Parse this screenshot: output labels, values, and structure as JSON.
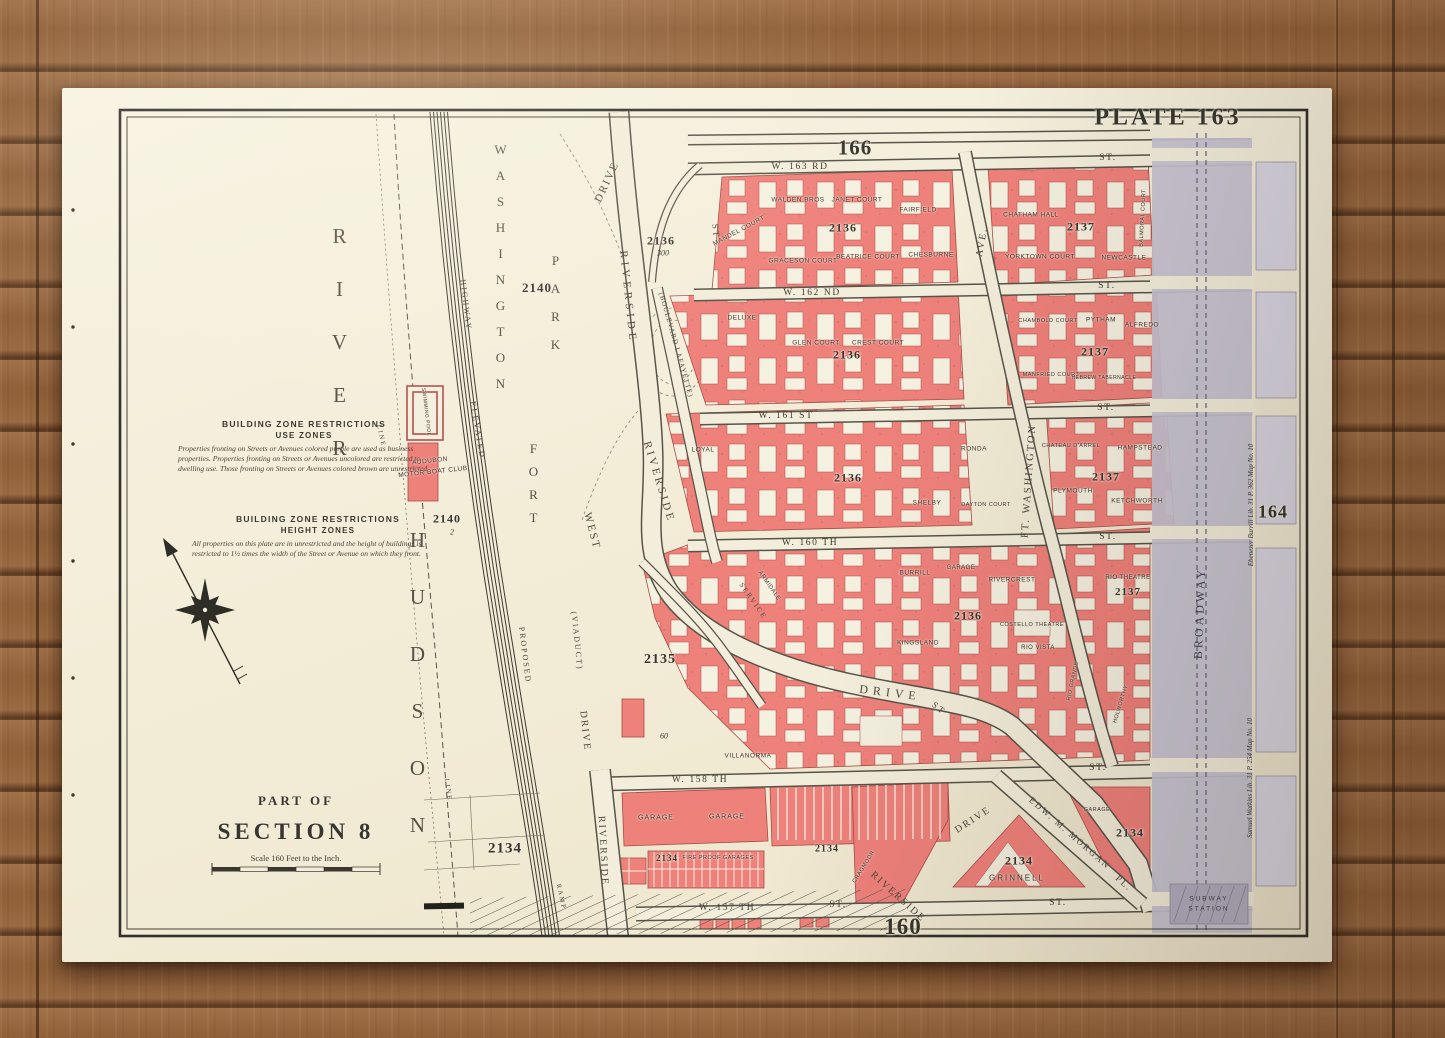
{
  "plate": {
    "label": "PLATE 163",
    "adjoining_top": "166",
    "adjoining_right": "164",
    "adjoining_bottom": "160"
  },
  "title_block": {
    "part_of": "PART OF",
    "section": "SECTION 8",
    "scale": "Scale 160 Feet to the Inch."
  },
  "zone_notes": {
    "use_title": "BUILDING ZONE RESTRICTIONS",
    "use_subtitle": "USE ZONES",
    "use_text": "Properties fronting on Streets or Avenues colored purple are used as business properties. Properties fronting on Streets or Avenues uncolored are restricted to dwelling use. Those fronting on Streets or Avenues colored brown are unrestricted.",
    "height_title": "BUILDING ZONE RESTRICTIONS",
    "height_subtitle": "HEIGHT ZONES",
    "height_text": "All properties on this plate are in unrestricted and the height of buildings is restricted to 1½ times the width of the Street or Avenue on which they front."
  },
  "water": {
    "hudson": "HUDSON",
    "river": "RIVER"
  },
  "park": {
    "fort": "FORT",
    "washington": "WASHINGTON",
    "park": "PARK",
    "pool": "SWIMMING POOL",
    "audubon_line1": "AUDUBON",
    "audubon_line2": "MOTOR BOAT CLUB"
  },
  "numbers": {
    "n2140_park": "2140",
    "n2140_club": "2140",
    "n2_lot": "2",
    "n2136_circle": "2136",
    "n300": "300",
    "n2135": "2135",
    "n2134_shore": "2134",
    "n60": "60"
  },
  "railroad": {
    "elevated": "ELEVATED",
    "highway": "HIGHWAY",
    "proposed": "PROPOSED",
    "ramp": "RAMP",
    "line": "LINE"
  },
  "roads": {
    "drive_top": "DRIVE",
    "riverside_upper": "RIVERSIDE",
    "boulevard_lafayette": "(BOULEVARD LAFAYETTE)",
    "riverside_mid": "RIVERSIDE",
    "west": "WEST",
    "viaduct": "(VIADUCT)",
    "drive_viaduct": "DRIVE",
    "riverside_sw": "RIVERSIDE",
    "service": "SERVICE",
    "drive_curve": "DRIVE",
    "st_curve": "ST",
    "st_upper": "ST",
    "riverside_diag": "RIVERSIDE",
    "drive_diag": "DRIVE",
    "ft_washington": "FT. WASHINGTON",
    "ave": "AVE.",
    "broadway": "BROADWAY",
    "edw_morgan": "EDW. M. MORGAN",
    "morgan_pl": "PL."
  },
  "streets": [
    {
      "name": "W. 163 RD",
      "suffix": "ST."
    },
    {
      "name": "W. 162 ND",
      "suffix": "ST."
    },
    {
      "name": "W. 161 ST",
      "suffix": "ST."
    },
    {
      "name": "W. 160 TH",
      "suffix": "ST."
    },
    {
      "name": "W. 158 TH",
      "suffix": "ST."
    },
    {
      "name": "W. 157 TH",
      "suffix": "ST.",
      "suffix_east": "ST."
    }
  ],
  "subway": {
    "line1": "SUBWAY",
    "line2": "STATION"
  },
  "blocks": [
    {
      "number": "2136",
      "buildings": {
        "mandel": "MANDEL COURT",
        "walden": "WALDEN BROS",
        "janet": "JANET COURT",
        "fairfield": "FAIRFIELD",
        "graceson": "GRACESON COURT",
        "beatrice": "BEATRICE COURT",
        "chesburne": "CHESBURNE"
      }
    },
    {
      "number": "2137",
      "buildings": {
        "chatham": "CHATHAM HALL",
        "balmoral": "BALMORAL COURT",
        "yorktown": "YORKTOWN COURT",
        "newcastle": "NEWCASTLE"
      }
    },
    {
      "number": "2136",
      "buildings": {
        "deluxe": "DELUXE",
        "glen": "GLEN COURT",
        "crest": "CREST COURT"
      }
    },
    {
      "number": "2137",
      "buildings": {
        "chambold": "CHAMBOLD COURT",
        "pytham": "PYTHAM",
        "alfredo": "ALFREDO",
        "manfried": "MANFRIED COURT",
        "tabernacle": "HEBREW TABERNACLE"
      }
    },
    {
      "number": "2136",
      "buildings": {
        "loyal": "LOYAL",
        "shelby": "SHELBY",
        "dayton": "DAYTON COURT",
        "ronda": "RONDA"
      }
    },
    {
      "number": "2137",
      "buildings": {
        "chateau": "CHATEAU D'ARREL",
        "hampstead": "HAMPSTEAD",
        "plymouth": "PLYMOUTH",
        "ketchworth": "KETCHWORTH"
      }
    },
    {
      "number": "2136",
      "buildings": {
        "armidale": "ARMIDALE",
        "burrill": "BURRILL",
        "garage": "GARAGE",
        "rivercrest": "RIVERCREST",
        "kingsland": "KINGSLAND",
        "costello": "COSTELLO THEATRE",
        "riovista": "RIO VISTA",
        "villanorma": "VILLANORMA"
      }
    },
    {
      "number": "2137",
      "buildings": {
        "rio": "RIO THEATRE",
        "riogrande": "RIO GRANDE",
        "holworthy": "HOLWORTHY"
      }
    },
    {
      "number": "2134",
      "buildings": {
        "garage_w": "GARAGE",
        "garage_e": "GARAGE",
        "fireproof": "FIRE PROOF GARAGES"
      }
    },
    {
      "number": "2134",
      "buildings": {
        "cragmoor": "CRAGMOOR"
      }
    },
    {
      "number": "2134",
      "buildings": {
        "grinnell": "GRINNELL"
      }
    },
    {
      "number": "2134",
      "buildings": {
        "garage": "GARAGE"
      }
    }
  ],
  "margin_notes": {
    "right_upper": "Ebenezer Burrill  Lib. 31  P. 362  Map No. 10",
    "right_lower": "Samuel Watkins  Lib. 31  P. 254  Map No. 10"
  },
  "colors": {
    "block_pink": "#ef817b",
    "broadway_gray": "#c6c3d2",
    "paper": "#f3eedb",
    "wood": "#96663e"
  }
}
